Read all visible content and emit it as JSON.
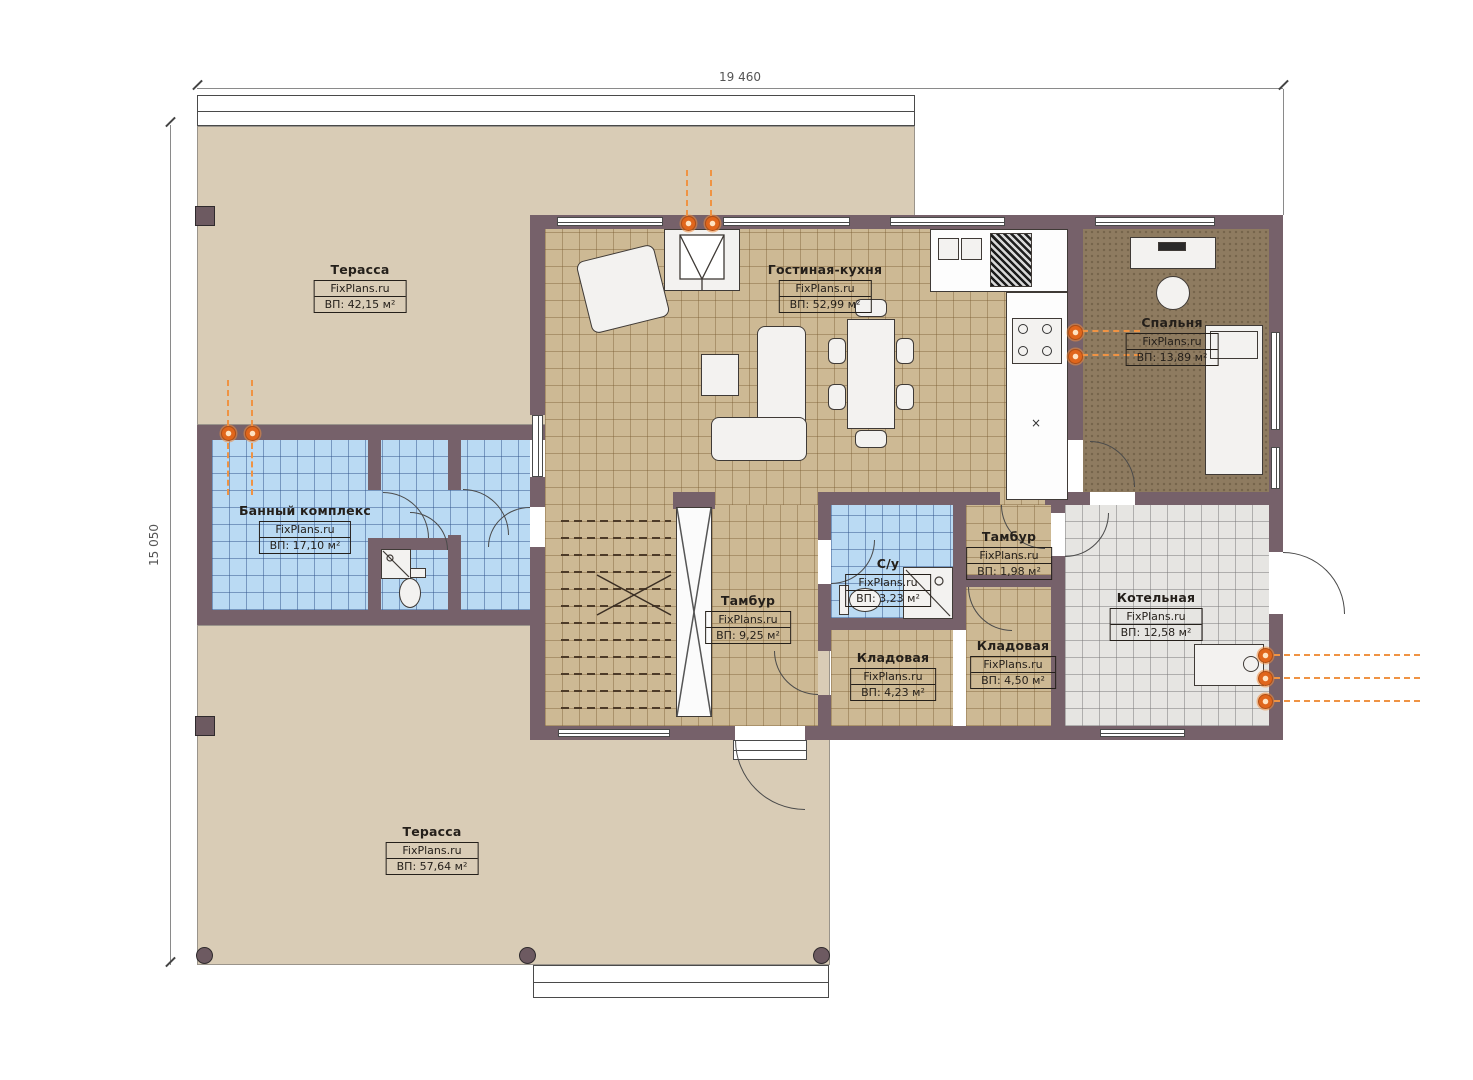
{
  "brand": "FixPlans.ru",
  "dimensions": {
    "top": "19 460",
    "left": "15 050"
  },
  "rooms": {
    "terrace_top": {
      "name": "Терасса",
      "site": "FixPlans.ru",
      "area": "ВП: 42,15 м²"
    },
    "living": {
      "name": "Гостиная-кухня",
      "site": "FixPlans.ru",
      "area": "ВП: 52,99 м²"
    },
    "bedroom": {
      "name": "Спальня",
      "site": "FixPlans.ru",
      "area": "ВП: 13,89 м²"
    },
    "bath": {
      "name": "Банный комплекс",
      "site": "FixPlans.ru",
      "area": "ВП: 17,10 м²"
    },
    "tambur_main": {
      "name": "Тамбур",
      "site": "FixPlans.ru",
      "area": "ВП: 9,25 м²"
    },
    "wc": {
      "name": "С/у",
      "site": "FixPlans.ru",
      "area": "ВП: 3,23 м²"
    },
    "tambur_small": {
      "name": "Тамбур",
      "site": "FixPlans.ru",
      "area": "ВП: 1,98 м²"
    },
    "storage_a": {
      "name": "Кладовая",
      "site": "FixPlans.ru",
      "area": "ВП: 4,23 м²"
    },
    "storage_b": {
      "name": "Кладовая",
      "site": "FixPlans.ru",
      "area": "ВП: 4,50 м²"
    },
    "boiler": {
      "name": "Котельная",
      "site": "FixPlans.ru",
      "area": "ВП: 12,58 м²"
    },
    "terrace_bottom": {
      "name": "Терасса",
      "site": "FixPlans.ru",
      "area": "ВП: 57,64 м²"
    }
  },
  "misc": {
    "x_mark": "×"
  },
  "colors": {
    "wall": "#76616a",
    "floor_tan": "#cdb994",
    "floor_blue": "#badaf3",
    "floor_gray": "#e6e5e2",
    "floor_bedroom": "#8e7b60",
    "terrace": "#d9ccb6",
    "lamp_accent": "#e0661c"
  }
}
